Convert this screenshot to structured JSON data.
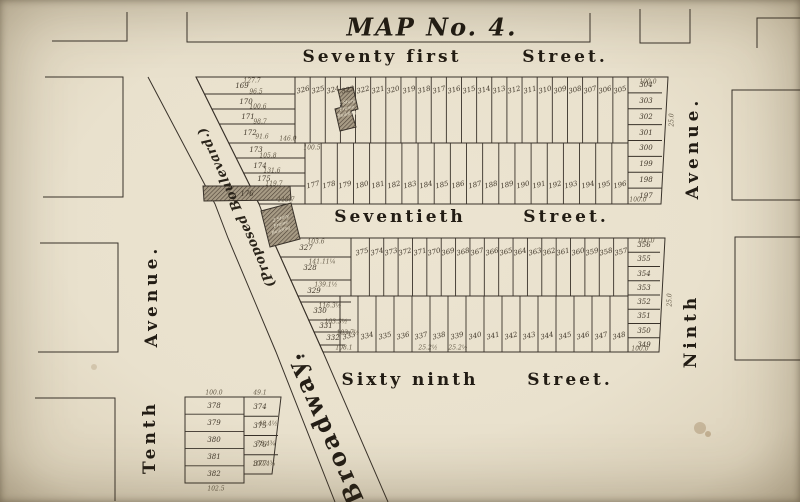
{
  "title": "MAP No. 4.",
  "colors": {
    "paper": "#e9e1cd",
    "line": "#39322a",
    "hatch_bg": "#a79b85",
    "hatch_line": "#4c4136"
  },
  "labels": [
    {
      "name": "street-seventy-first",
      "t": "Seventy first",
      "x": 382,
      "y": 57,
      "rot": 0,
      "cls": "street"
    },
    {
      "name": "street-seventy-first-suffix",
      "t": "Street.",
      "x": 565,
      "y": 57,
      "rot": 0,
      "cls": "street"
    },
    {
      "name": "street-seventieth",
      "t": "Seventieth",
      "x": 400,
      "y": 217,
      "rot": 0,
      "cls": "street"
    },
    {
      "name": "street-seventieth-suffix",
      "t": "Street.",
      "x": 566,
      "y": 217,
      "rot": 0,
      "cls": "street"
    },
    {
      "name": "street-sixty-ninth",
      "t": "Sixty ninth",
      "x": 410,
      "y": 380,
      "rot": 0,
      "cls": "street"
    },
    {
      "name": "street-sixty-ninth-suffix",
      "t": "Street.",
      "x": 570,
      "y": 380,
      "rot": 0,
      "cls": "street"
    },
    {
      "name": "avenue-tenth",
      "t": "Tenth",
      "x": 150,
      "y": 437,
      "rot": -90,
      "cls": "avenue"
    },
    {
      "name": "avenue-tenth-suffix",
      "t": "Avenue.",
      "x": 152,
      "y": 296,
      "rot": -90,
      "cls": "avenue"
    },
    {
      "name": "avenue-ninth",
      "t": "Ninth",
      "x": 691,
      "y": 331,
      "rot": -90,
      "cls": "avenue"
    },
    {
      "name": "avenue-ninth-suffix",
      "t": "Avenue.",
      "x": 693,
      "y": 148,
      "rot": -90,
      "cls": "avenue"
    },
    {
      "name": "road-proposed-boulevard",
      "t": "(Proposed Boulevard.)",
      "x": 237,
      "y": 207,
      "rot": -114,
      "cls": "road-small"
    },
    {
      "name": "road-broadway",
      "t": "Broadway.",
      "x": 323,
      "y": 428,
      "rot": -114,
      "cls": "road-big"
    }
  ],
  "dims": [
    {
      "t": "127.7",
      "x": 252,
      "y": 81
    },
    {
      "t": "96.5",
      "x": 256,
      "y": 92
    },
    {
      "t": "100.6",
      "x": 258,
      "y": 107
    },
    {
      "t": "98.7",
      "x": 260,
      "y": 122
    },
    {
      "t": "91.6",
      "x": 262,
      "y": 137
    },
    {
      "t": "146.0",
      "x": 288,
      "y": 139
    },
    {
      "t": "105.8",
      "x": 268,
      "y": 156
    },
    {
      "t": "131.6",
      "x": 272,
      "y": 171
    },
    {
      "t": "119.7",
      "x": 274,
      "y": 184
    },
    {
      "t": "113.7",
      "x": 286,
      "y": 200
    },
    {
      "t": "100.5",
      "x": 312,
      "y": 148
    },
    {
      "t": "100.0",
      "x": 648,
      "y": 82
    },
    {
      "t": "100.0",
      "x": 638,
      "y": 200
    },
    {
      "t": "25.0",
      "x": 672,
      "y": 120,
      "rot": -90
    },
    {
      "t": "25.0",
      "x": 670,
      "y": 300,
      "rot": -90
    },
    {
      "t": "103.6",
      "x": 316,
      "y": 242
    },
    {
      "t": "141.11¼",
      "x": 322,
      "y": 262
    },
    {
      "t": "139.1½",
      "x": 326,
      "y": 285
    },
    {
      "t": "116.3½",
      "x": 330,
      "y": 306
    },
    {
      "t": "103.3½",
      "x": 336,
      "y": 322
    },
    {
      "t": "103.7½",
      "x": 348,
      "y": 333
    },
    {
      "t": "108.1",
      "x": 344,
      "y": 348
    },
    {
      "t": "100.0",
      "x": 646,
      "y": 241
    },
    {
      "t": "100.0",
      "x": 640,
      "y": 349
    },
    {
      "t": "25.2½",
      "x": 428,
      "y": 348
    },
    {
      "t": "25.2½",
      "x": 458,
      "y": 348
    },
    {
      "t": "100.0",
      "x": 214,
      "y": 393
    },
    {
      "t": "49.1",
      "x": 260,
      "y": 393
    },
    {
      "t": "48.4½",
      "x": 268,
      "y": 424
    },
    {
      "t": "78.4¾",
      "x": 266,
      "y": 444
    },
    {
      "t": "100.4¾",
      "x": 264,
      "y": 464
    },
    {
      "t": "102.5",
      "x": 216,
      "y": 489
    }
  ],
  "geometry": {
    "polylines": [
      {
        "name": "edge-block-top-left",
        "pts": [
          [
            52,
            41
          ],
          [
            127,
            41
          ],
          [
            127,
            12
          ]
        ]
      },
      {
        "name": "edge-block-left-upper",
        "pts": [
          [
            45,
            77
          ],
          [
            123,
            77
          ],
          [
            123,
            197
          ],
          [
            43,
            197
          ]
        ]
      },
      {
        "name": "edge-block-left-middle",
        "pts": [
          [
            40,
            243
          ],
          [
            118,
            243
          ],
          [
            118,
            352
          ],
          [
            38,
            352
          ]
        ]
      },
      {
        "name": "edge-block-left-lower",
        "pts": [
          [
            35,
            398
          ],
          [
            115,
            398
          ],
          [
            115,
            501
          ]
        ]
      },
      {
        "name": "title-block-outline",
        "pts": [
          [
            187,
            12
          ],
          [
            187,
            42
          ],
          [
            590,
            42
          ],
          [
            590,
            13
          ]
        ]
      },
      {
        "name": "edge-block-top-middle",
        "pts": [
          [
            640,
            9
          ],
          [
            640,
            43
          ],
          [
            690,
            43
          ],
          [
            690,
            9
          ]
        ]
      },
      {
        "name": "edge-block-top-right",
        "pts": [
          [
            757,
            48
          ],
          [
            757,
            18
          ],
          [
            800,
            18
          ]
        ]
      },
      {
        "name": "edge-block-right-upper",
        "pts": [
          [
            800,
            90
          ],
          [
            732,
            90
          ],
          [
            732,
            200
          ],
          [
            800,
            200
          ]
        ]
      },
      {
        "name": "edge-block-right-lower",
        "pts": [
          [
            800,
            237
          ],
          [
            735,
            237
          ],
          [
            735,
            360
          ],
          [
            800,
            360
          ]
        ]
      },
      {
        "name": "broadway-east-edge",
        "pts": [
          [
            196,
            77
          ],
          [
            259,
            204
          ],
          [
            272,
            238
          ],
          [
            323,
            352
          ],
          [
            388,
            502
          ]
        ]
      },
      {
        "name": "broadway-west-edge",
        "pts": [
          [
            148,
            77
          ],
          [
            215,
            204
          ],
          [
            228,
            238
          ],
          [
            276,
            352
          ],
          [
            335,
            502
          ]
        ]
      },
      {
        "name": "upper-block-outline",
        "pts": [
          [
            196,
            77
          ],
          [
            668,
            77
          ],
          [
            661,
            204
          ],
          [
            259,
            204
          ]
        ],
        "close": true
      },
      {
        "name": "lower-block-outline",
        "pts": [
          [
            272,
            238
          ],
          [
            665,
            238
          ],
          [
            659,
            352
          ],
          [
            323,
            352
          ]
        ],
        "close": true
      },
      {
        "name": "upper-block-center-line",
        "pts": [
          [
            229,
            143
          ],
          [
            628,
            143
          ]
        ]
      },
      {
        "name": "lower-block-center-line",
        "pts": [
          [
            298,
            296
          ],
          [
            628,
            296
          ]
        ]
      },
      {
        "name": "upper-left-row-divider",
        "pts": [
          [
            205,
            94
          ],
          [
            295,
            94
          ]
        ]
      },
      {
        "name": "upper-left-row-divider",
        "pts": [
          [
            212,
            109
          ],
          [
            295,
            109
          ]
        ]
      },
      {
        "name": "upper-left-row-divider",
        "pts": [
          [
            219,
            124
          ],
          [
            295,
            124
          ]
        ]
      },
      {
        "name": "upper-left-row-divider",
        "pts": [
          [
            236,
            158
          ],
          [
            305,
            158
          ]
        ]
      },
      {
        "name": "upper-left-row-divider",
        "pts": [
          [
            243,
            173
          ],
          [
            305,
            173
          ]
        ]
      },
      {
        "name": "upper-left-row-divider",
        "pts": [
          [
            248,
            186
          ],
          [
            305,
            186
          ]
        ]
      },
      {
        "name": "lower-left-row-divider",
        "pts": [
          [
            280,
            257
          ],
          [
            351,
            257
          ]
        ]
      },
      {
        "name": "lower-left-row-divider",
        "pts": [
          [
            290,
            280
          ],
          [
            351,
            280
          ]
        ]
      },
      {
        "name": "lower-left-row-divider",
        "pts": [
          [
            300,
            302
          ],
          [
            351,
            302
          ]
        ]
      },
      {
        "name": "lower-left-row-divider",
        "pts": [
          [
            308,
            320
          ],
          [
            351,
            320
          ]
        ]
      },
      {
        "name": "lower-left-row-divider",
        "pts": [
          [
            314,
            332
          ],
          [
            351,
            332
          ]
        ]
      },
      {
        "name": "lower-left-row-divider",
        "pts": [
          [
            320,
            345
          ],
          [
            345,
            345
          ]
        ]
      },
      {
        "name": "section-divider",
        "pts": [
          [
            295,
            77
          ],
          [
            295,
            143
          ]
        ]
      },
      {
        "name": "section-divider",
        "pts": [
          [
            305,
            143
          ],
          [
            305,
            204
          ]
        ]
      },
      {
        "name": "section-divider",
        "pts": [
          [
            351,
            238
          ],
          [
            351,
            296
          ]
        ]
      },
      {
        "name": "section-divider",
        "pts": [
          [
            340,
            296
          ],
          [
            340,
            352
          ]
        ]
      },
      {
        "name": "section-divider",
        "pts": [
          [
            628,
            77
          ],
          [
            628,
            204
          ]
        ]
      },
      {
        "name": "section-divider",
        "pts": [
          [
            628,
            238
          ],
          [
            628,
            352
          ]
        ]
      },
      {
        "name": "small-block-left-outline",
        "pts": [
          [
            185,
            397
          ],
          [
            244,
            397
          ],
          [
            244,
            483
          ],
          [
            185,
            483
          ]
        ],
        "close": true
      },
      {
        "name": "small-block-right-outline",
        "pts": [
          [
            244,
            397
          ],
          [
            281,
            397
          ],
          [
            272,
            474
          ],
          [
            244,
            474
          ]
        ],
        "close": true
      }
    ],
    "strips": [
      {
        "name": "upper-north-lots",
        "x0": 295,
        "x1": 628,
        "y0": 77,
        "y1": 143,
        "label_y": 90,
        "lots": [
          "326",
          "325",
          "324",
          "323",
          "322",
          "321",
          "320",
          "319",
          "318",
          "317",
          "316",
          "315",
          "314",
          "313",
          "312",
          "311",
          "310",
          "309",
          "308",
          "307",
          "306",
          "305"
        ]
      },
      {
        "name": "upper-south-lots",
        "x0": 305,
        "x1": 628,
        "y0": 143,
        "y1": 204,
        "label_y": 185,
        "lots": [
          "177",
          "178",
          "179",
          "180",
          "181",
          "182",
          "183",
          "184",
          "185",
          "186",
          "187",
          "188",
          "189",
          "190",
          "191",
          "192",
          "193",
          "194",
          "195",
          "196"
        ]
      },
      {
        "name": "lower-north-lots",
        "x0": 355,
        "x1": 628,
        "y0": 238,
        "y1": 296,
        "label_y": 252,
        "lots": [
          "375",
          "374",
          "373",
          "372",
          "371",
          "370",
          "369",
          "368",
          "367",
          "366",
          "365",
          "364",
          "363",
          "362",
          "361",
          "360",
          "359",
          "358",
          "357"
        ]
      },
      {
        "name": "lower-south-lots",
        "x0": 340,
        "x1": 628,
        "y0": 296,
        "y1": 352,
        "label_y": 336,
        "lots": [
          "333",
          "334",
          "335",
          "336",
          "337",
          "338",
          "339",
          "340",
          "341",
          "342",
          "343",
          "344",
          "345",
          "346",
          "347",
          "348"
        ]
      }
    ],
    "stacks": [
      {
        "name": "upper-right-column",
        "x0": 628,
        "x1": 662,
        "y0": 77,
        "y1": 204,
        "lx": 646,
        "rows": [
          "304",
          "303",
          "302",
          "301",
          "300",
          "199",
          "198",
          "197"
        ]
      },
      {
        "name": "lower-right-column",
        "x0": 628,
        "x1": 660,
        "y0": 238,
        "y1": 352,
        "lx": 644,
        "rows": [
          "356",
          "355",
          "354",
          "353",
          "352",
          "351",
          "350",
          "349"
        ]
      },
      {
        "name": "small-block-left-column",
        "x0": 185,
        "x1": 244,
        "y0": 397,
        "y1": 483,
        "lx": 214,
        "rows": [
          "378",
          "379",
          "380",
          "381",
          "382"
        ]
      },
      {
        "name": "small-block-right-column",
        "x0": 244,
        "x1": 278,
        "y0": 397,
        "y1": 474,
        "lx": 260,
        "rows": [
          "374",
          "375",
          "376",
          "377"
        ]
      }
    ],
    "row_labels": [
      {
        "t": "169",
        "x": 242,
        "y": 86
      },
      {
        "t": "170",
        "x": 246,
        "y": 102
      },
      {
        "t": "171",
        "x": 248,
        "y": 117
      },
      {
        "t": "172",
        "x": 250,
        "y": 133
      },
      {
        "t": "173",
        "x": 256,
        "y": 150
      },
      {
        "t": "174",
        "x": 260,
        "y": 166
      },
      {
        "t": "175",
        "x": 264,
        "y": 179
      },
      {
        "t": "176",
        "x": 247,
        "y": 194
      },
      {
        "t": "327",
        "x": 306,
        "y": 248
      },
      {
        "t": "328",
        "x": 310,
        "y": 268
      },
      {
        "t": "329",
        "x": 314,
        "y": 291
      },
      {
        "t": "330",
        "x": 320,
        "y": 311
      },
      {
        "t": "331",
        "x": 326,
        "y": 326
      },
      {
        "t": "332",
        "x": 333,
        "y": 338
      }
    ],
    "buildings": [
      {
        "name": "frame-building-upper",
        "poly": [
          [
            338,
            90
          ],
          [
            353,
            87
          ],
          [
            358,
            109
          ],
          [
            351,
            111
          ],
          [
            356,
            127
          ],
          [
            340,
            131
          ],
          [
            335,
            109
          ],
          [
            342,
            107
          ]
        ],
        "label": [
          "2 Story",
          "Frame",
          "Building"
        ],
        "lx": 347,
        "ly": 109,
        "lrot": -12
      },
      {
        "name": "building-lot-176",
        "poly": [
          [
            203,
            186
          ],
          [
            290,
            186
          ],
          [
            291,
            200
          ],
          [
            204,
            201
          ]
        ],
        "label": [],
        "lx": 0,
        "ly": 0,
        "lrot": 0
      },
      {
        "name": "frame-building-lower",
        "poly": [
          [
            261,
            211
          ],
          [
            291,
            203
          ],
          [
            300,
            239
          ],
          [
            270,
            247
          ]
        ],
        "label": [
          "2 Story",
          "Frame",
          "Building"
        ],
        "lx": 281,
        "ly": 225,
        "lrot": -18
      }
    ],
    "stains": [
      {
        "x": 303,
        "y": 356,
        "r": 1.5,
        "c": "#2e2a24"
      },
      {
        "x": 700,
        "y": 428,
        "r": 6,
        "c": "rgba(130,95,50,0.28)"
      },
      {
        "x": 708,
        "y": 434,
        "r": 3,
        "c": "rgba(130,95,50,0.33)"
      },
      {
        "x": 94,
        "y": 367,
        "r": 3,
        "c": "rgba(140,110,70,0.22)"
      }
    ]
  }
}
